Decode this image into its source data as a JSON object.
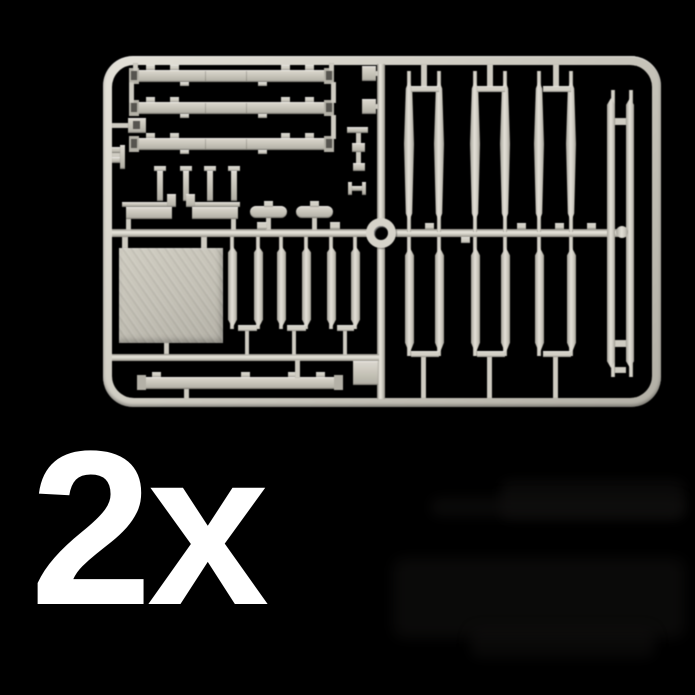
{
  "scene": {
    "background": "#000000",
    "subject": "plastic-model-sprue-photo"
  },
  "quantity_label": {
    "text": "2x",
    "color": "#ffffff"
  },
  "sprue": {
    "plastic_base": "#d4d1c7",
    "plastic_highlight": "#e9e6dd",
    "plastic_shadow": "#8e8b82",
    "part_face": "#c5c2b7",
    "panel_face": "#c3c0b5",
    "ghost_shadow": "#121110"
  }
}
